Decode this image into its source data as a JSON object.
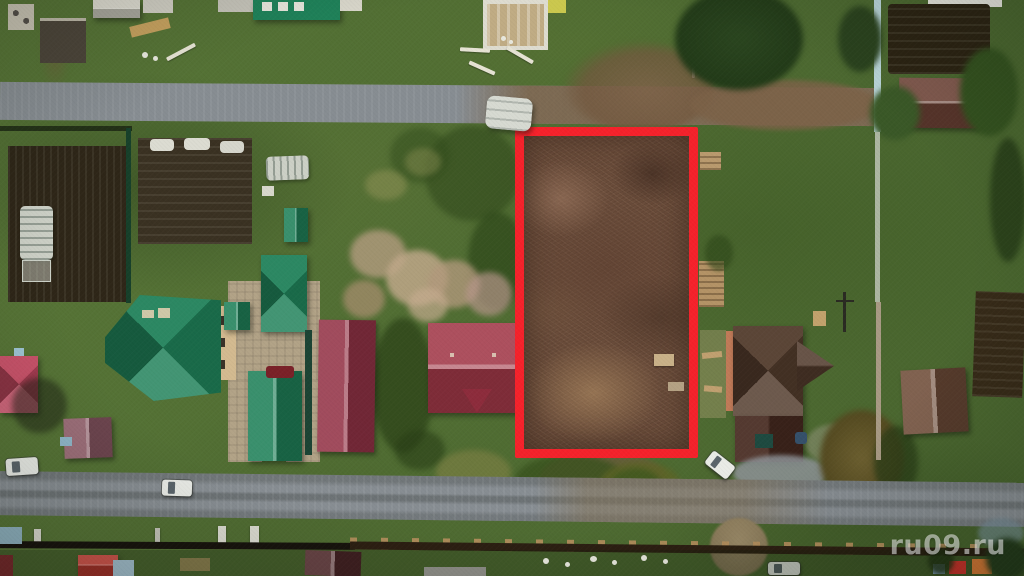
{
  "watermark": {
    "text": "ru09.ru"
  },
  "highlight": {
    "outline_color": "#f5222b"
  },
  "palette": {
    "grass": "#547336",
    "road_gravel": "#878d92",
    "plot_soil": "#6a4c3a",
    "green_roof": "#1f8159",
    "maroon_roof": "#943347",
    "red_roof": "#a23848",
    "brown_roof": "#513a2b",
    "small_house_roof": "#6f4c38",
    "shed_roof_brown": "#6e4236"
  }
}
